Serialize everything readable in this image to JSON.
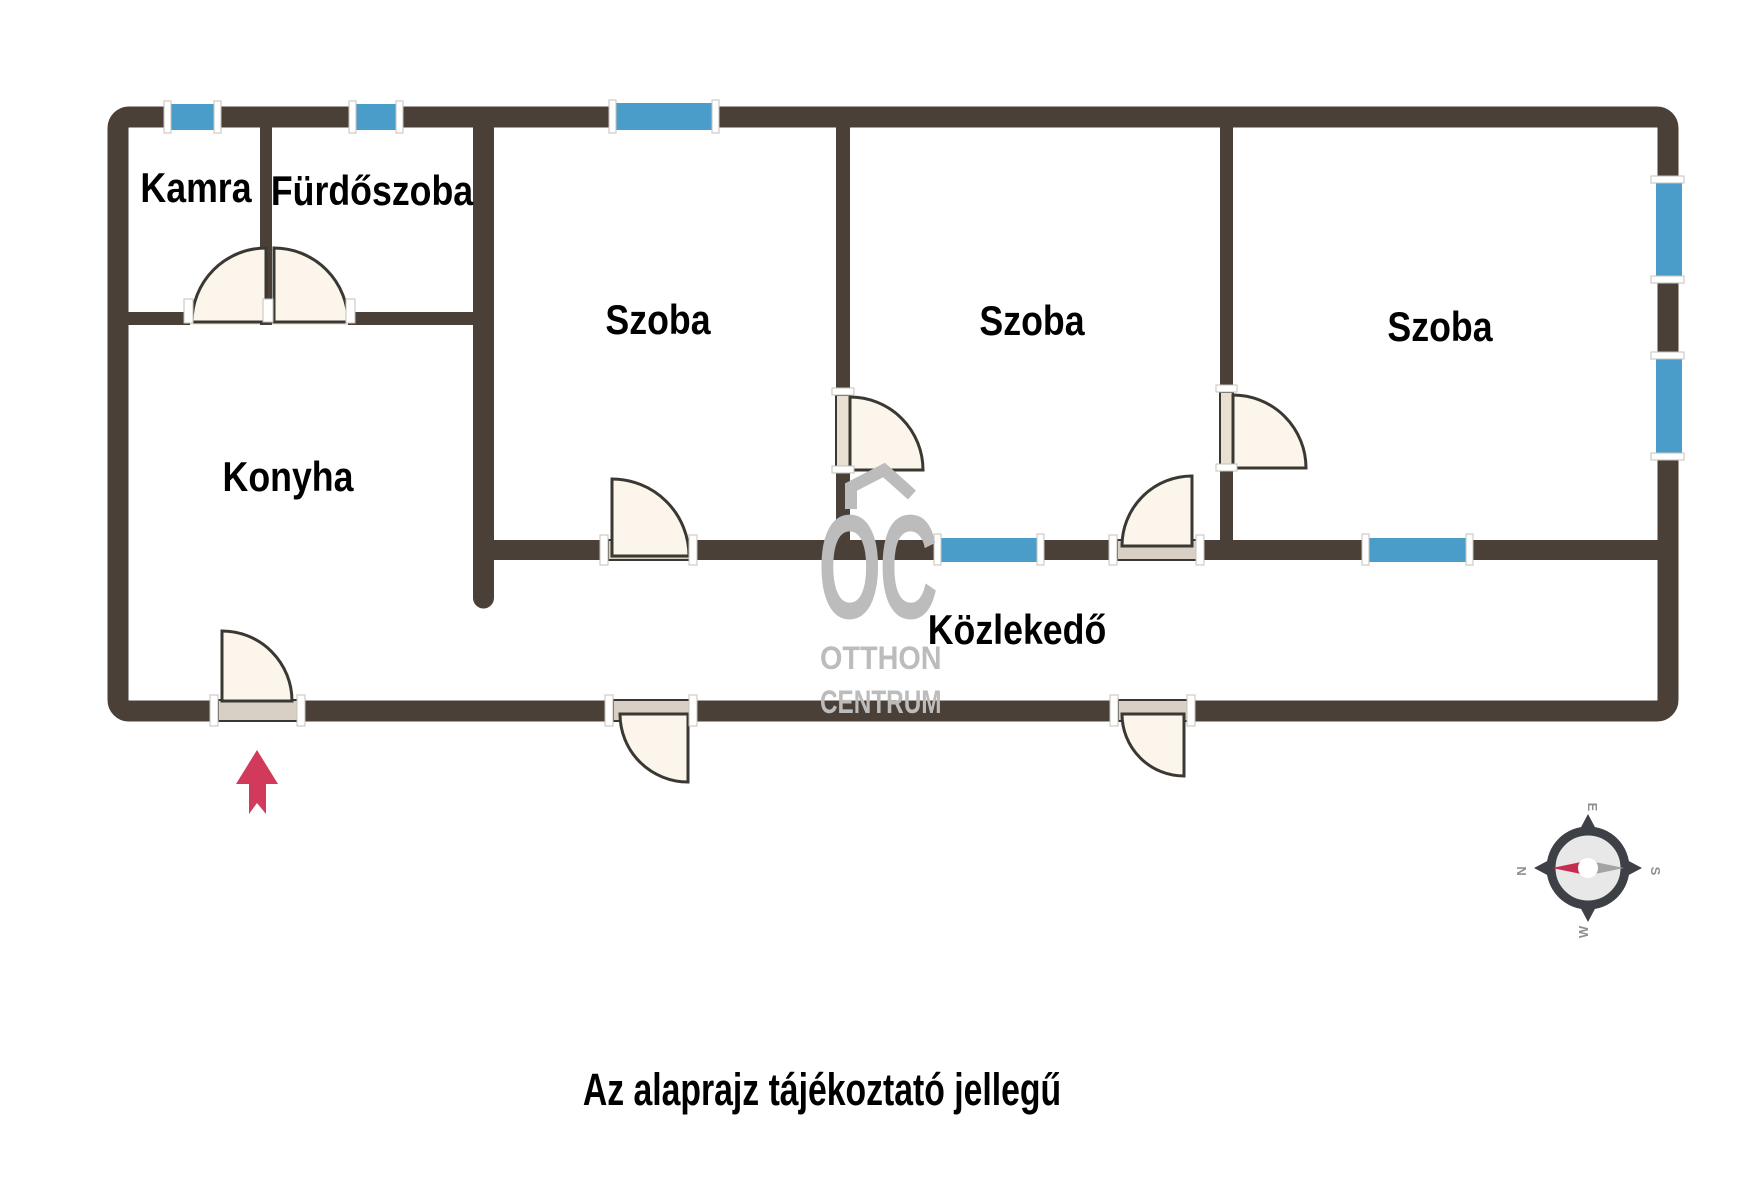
{
  "rooms": [
    {
      "name": "kamra",
      "label": "Kamra"
    },
    {
      "name": "furdoszoba",
      "label": "Fürdőszoba"
    },
    {
      "name": "szoba-1",
      "label": "Szoba"
    },
    {
      "name": "szoba-2",
      "label": "Szoba"
    },
    {
      "name": "szoba-3",
      "label": "Szoba"
    },
    {
      "name": "konyha",
      "label": "Konyha"
    },
    {
      "name": "kozlekedo",
      "label": "Közlekedő"
    }
  ],
  "caption": "Az alaprajz tájékoztató jellegű",
  "watermark": {
    "logo": "OC",
    "line1": "OTTHON",
    "line2": "CENTRUM"
  },
  "compass": {
    "north": "N",
    "east": "E",
    "south": "S",
    "west": "W"
  },
  "colors": {
    "wall": "#4B4037",
    "window": "#4A9CC9",
    "door_swing": "#FCF5EB",
    "door_threshold": "#D8D0C4",
    "entrance_arrow": "#D23A5C",
    "watermark": "#BCBCBC",
    "compass_needle_red": "#C62C50",
    "compass_needle_gray": "#A3A3A3"
  }
}
